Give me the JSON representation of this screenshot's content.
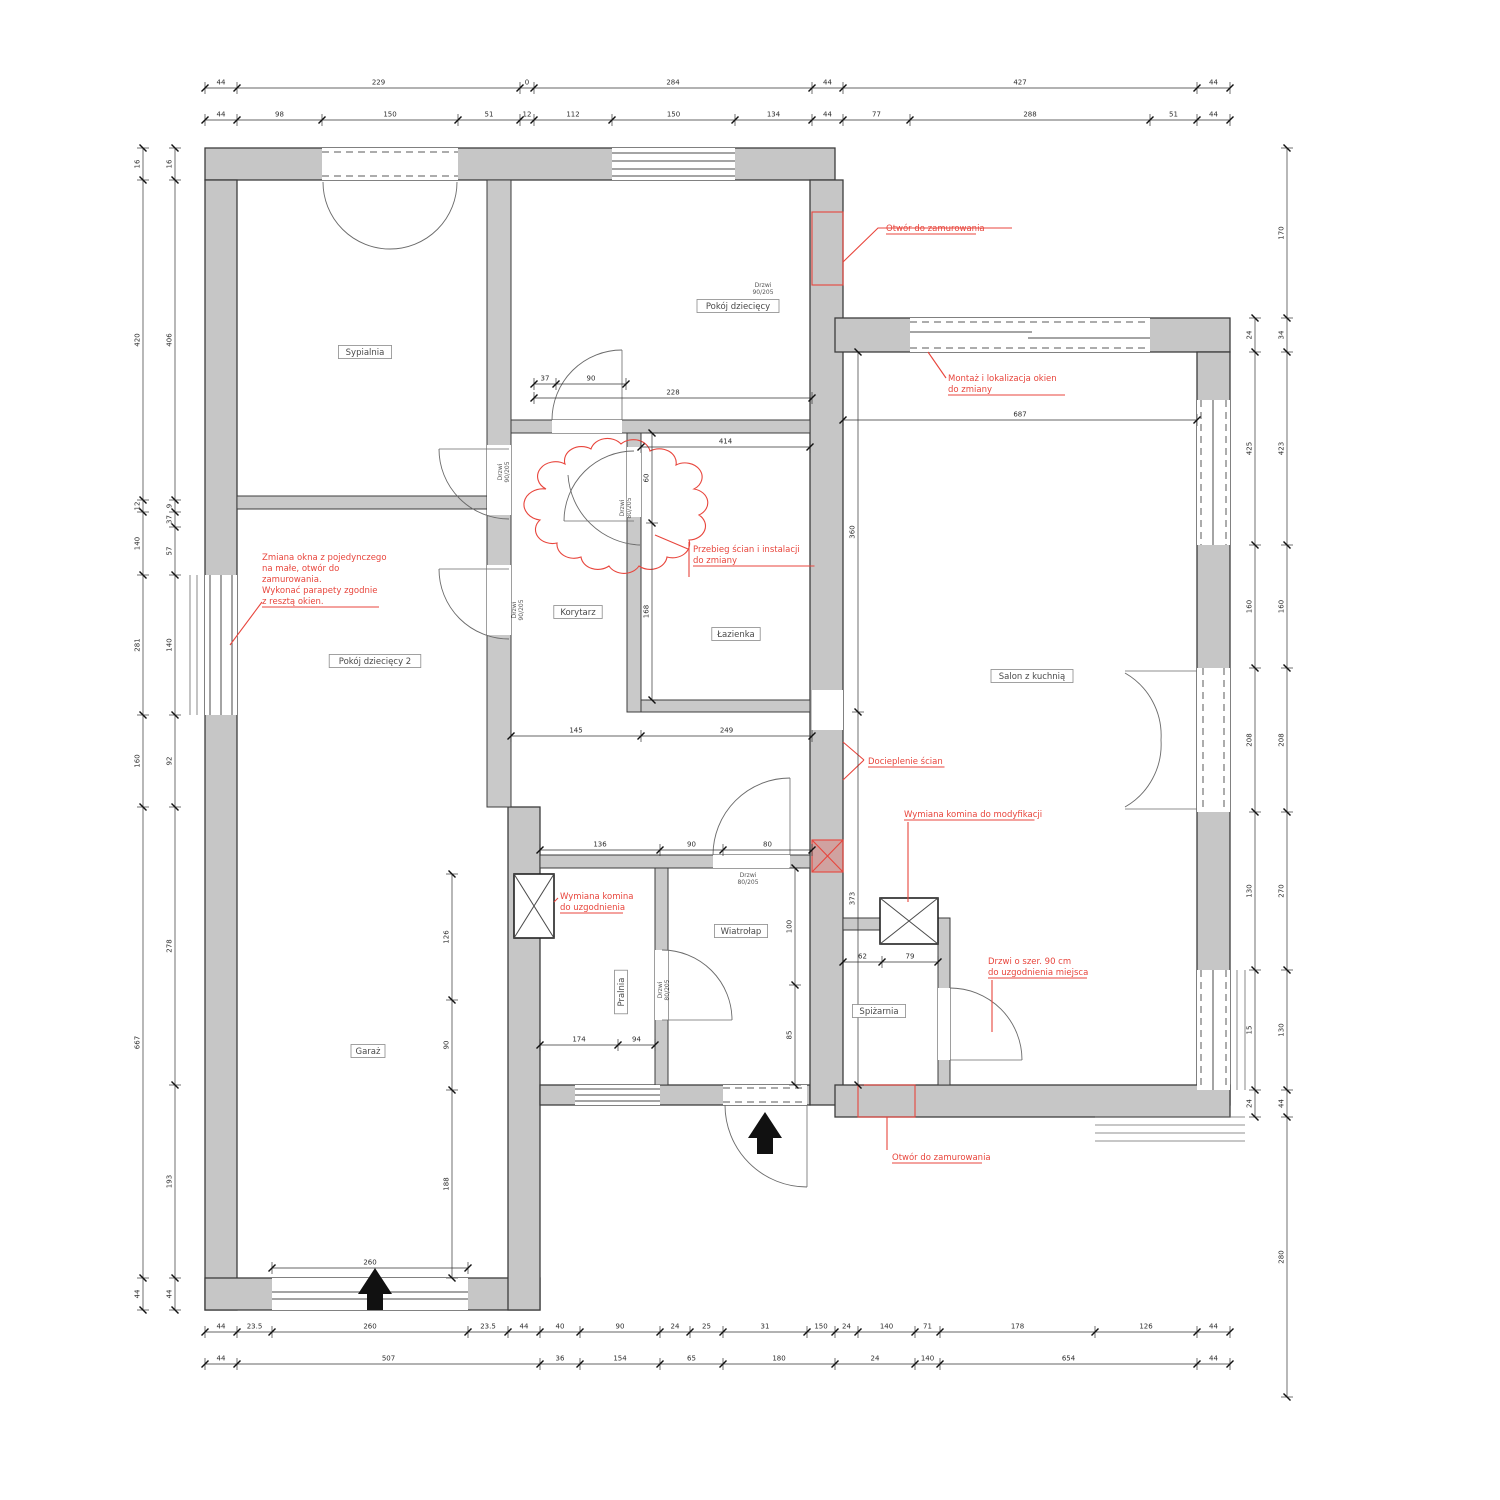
{
  "colors": {
    "wall_fill": "#c6c6c6",
    "wall_stroke": "#3d3d3d",
    "dim": "#2e2e2e",
    "red": "#e8453c",
    "label": "#4a4a4a"
  },
  "rooms": [
    {
      "label": "Sypialnia",
      "x": 365,
      "y": 352,
      "rot": 0
    },
    {
      "label": "Pokój dziecięcy",
      "x": 738,
      "y": 306,
      "rot": 0
    },
    {
      "label": "Pokój dziecięcy 2",
      "x": 375,
      "y": 661,
      "rot": 0
    },
    {
      "label": "Korytarz",
      "x": 578,
      "y": 612,
      "rot": 0
    },
    {
      "label": "Łazienka",
      "x": 736,
      "y": 634,
      "rot": 0
    },
    {
      "label": "Salon z kuchnią",
      "x": 1032,
      "y": 676,
      "rot": 0
    },
    {
      "label": "Wiatrołap",
      "x": 741,
      "y": 931,
      "rot": 0
    },
    {
      "label": "Pralnia",
      "x": 621,
      "y": 992,
      "rot": -90
    },
    {
      "label": "Spiżarnia",
      "x": 879,
      "y": 1011,
      "rot": 0
    },
    {
      "label": "Garaż",
      "x": 368,
      "y": 1051,
      "rot": 0
    }
  ],
  "door_tags": [
    {
      "lines": [
        "Drzwi",
        "90/205"
      ],
      "x": 763,
      "y": 287,
      "rot": 0
    },
    {
      "lines": [
        "Drzwi",
        "90/205"
      ],
      "x": 502,
      "y": 472,
      "rot": -90
    },
    {
      "lines": [
        "Drzwi",
        "90/205"
      ],
      "x": 516,
      "y": 610,
      "rot": -90
    },
    {
      "lines": [
        "Drzwi",
        "80/205"
      ],
      "x": 624,
      "y": 508,
      "rot": -90
    },
    {
      "lines": [
        "Drzwi",
        "80/205"
      ],
      "x": 748,
      "y": 877,
      "rot": 0
    },
    {
      "lines": [
        "Drzwi",
        "80/205"
      ],
      "x": 662,
      "y": 990,
      "rot": -90
    }
  ],
  "annotations": [
    {
      "x": 886,
      "y": 231,
      "lines": [
        "Otwór do zamurowania"
      ]
    },
    {
      "x": 948,
      "y": 381,
      "lines": [
        "Montaż i lokalizacja okien",
        "do zmiany"
      ]
    },
    {
      "x": 262,
      "y": 560,
      "lines": [
        "Zmiana okna z pojedynczego",
        "na małe, otwór do",
        "zamurowania.",
        "Wykonać parapety zgodnie",
        "z resztą okien."
      ]
    },
    {
      "x": 693,
      "y": 552,
      "lines": [
        "Przebieg ścian i instalacji",
        "do zmiany"
      ]
    },
    {
      "x": 868,
      "y": 764,
      "lines": [
        "Docieplenie ścian"
      ]
    },
    {
      "x": 904,
      "y": 817,
      "lines": [
        "Wymiana komina do modyfikacji"
      ]
    },
    {
      "x": 560,
      "y": 899,
      "lines": [
        "Wymiana komina",
        "do uzgodnienia"
      ]
    },
    {
      "x": 988,
      "y": 964,
      "lines": [
        "Drzwi o szer. 90 cm",
        "do uzgodnienia miejsca"
      ]
    },
    {
      "x": 892,
      "y": 1160,
      "lines": [
        "Otwór do zamurowania"
      ]
    }
  ],
  "dim_strips": [
    {
      "o": "h",
      "pos": 88,
      "ticks": [
        205,
        237,
        520,
        534,
        812,
        843,
        1197,
        1230
      ],
      "labels": [
        "44",
        "229",
        "0",
        "284",
        "44",
        "427",
        "44"
      ]
    },
    {
      "o": "h",
      "pos": 120,
      "ticks": [
        205,
        237,
        322,
        458,
        520,
        534,
        612,
        735,
        812,
        843,
        910,
        1150,
        1197,
        1230
      ],
      "labels": [
        "44",
        "98",
        "150",
        "51",
        "12",
        "112",
        "150",
        "134",
        "44",
        "77",
        "288",
        "51",
        "44"
      ]
    },
    {
      "o": "h",
      "pos": 1332,
      "ticks": [
        205,
        237,
        272,
        468,
        508,
        540,
        580,
        660,
        690,
        723,
        807,
        835,
        858,
        915,
        940,
        1095,
        1197,
        1230
      ],
      "labels": [
        "44",
        "23.5",
        "260",
        "23.5",
        "44",
        "40",
        "90",
        "24",
        "25",
        "31",
        "150",
        "24",
        "140",
        "71",
        "178",
        "126",
        "44"
      ]
    },
    {
      "o": "h",
      "pos": 1364,
      "ticks": [
        205,
        237,
        540,
        580,
        660,
        723,
        835,
        915,
        940,
        1197,
        1230
      ],
      "labels": [
        "44",
        "507",
        "36",
        "154",
        "65",
        "180",
        "24",
        "140",
        "654",
        "44"
      ]
    },
    {
      "o": "v",
      "pos": 143,
      "ticks": [
        148,
        180,
        500,
        512,
        575,
        715,
        807,
        1278,
        1310
      ],
      "labels": [
        "16",
        "420",
        "12",
        "140",
        "281",
        "160",
        "667",
        "44"
      ]
    },
    {
      "o": "v",
      "pos": 175,
      "ticks": [
        148,
        180,
        500,
        512,
        527,
        575,
        715,
        807,
        1085,
        1278,
        1310
      ],
      "labels": [
        "16",
        "406",
        "9",
        "37",
        "57",
        "140",
        "92",
        "278",
        "193",
        "44"
      ]
    },
    {
      "o": "v",
      "pos": 1287,
      "ticks": [
        148,
        318,
        352,
        545,
        668,
        812,
        970,
        1090,
        1117,
        1397
      ],
      "labels": [
        "170",
        "34",
        "423",
        "160",
        "208",
        "270",
        "130",
        "44",
        "280"
      ]
    },
    {
      "o": "v",
      "pos": 1255,
      "ticks": [
        318,
        352,
        545,
        668,
        812,
        970,
        1090,
        1117
      ],
      "labels": [
        "24",
        "425",
        "160",
        "208",
        "130",
        "15",
        "24"
      ]
    },
    {
      "o": "h",
      "pos": 398,
      "ticks": [
        534,
        812
      ],
      "labels": [
        "228"
      ]
    },
    {
      "o": "h",
      "pos": 447,
      "ticks": [
        641,
        810
      ],
      "labels": [
        "414"
      ]
    },
    {
      "o": "h",
      "pos": 420,
      "ticks": [
        843,
        1197
      ],
      "labels": [
        "687"
      ]
    },
    {
      "o": "h",
      "pos": 384,
      "ticks": [
        534,
        556,
        626
      ],
      "labels": [
        "37",
        "90"
      ]
    },
    {
      "o": "h",
      "pos": 736,
      "ticks": [
        511,
        641,
        812
      ],
      "labels": [
        "145",
        "249"
      ]
    },
    {
      "o": "h",
      "pos": 850,
      "ticks": [
        540,
        660,
        723,
        812
      ],
      "labels": [
        "136",
        "90",
        "80"
      ]
    },
    {
      "o": "v",
      "pos": 652,
      "ticks": [
        433,
        523,
        700
      ],
      "labels": [
        "60",
        "168"
      ]
    },
    {
      "o": "v",
      "pos": 452,
      "ticks": [
        874,
        1000,
        1090,
        1278
      ],
      "labels": [
        "126",
        "90",
        "188"
      ]
    },
    {
      "o": "h",
      "pos": 1045,
      "ticks": [
        540,
        618,
        655
      ],
      "labels": [
        "174",
        "94"
      ]
    },
    {
      "o": "v",
      "pos": 795,
      "ticks": [
        868,
        985,
        1085
      ],
      "labels": [
        "100",
        "85"
      ]
    },
    {
      "o": "h",
      "pos": 962,
      "ticks": [
        843,
        882,
        938
      ],
      "labels": [
        "62",
        "79"
      ]
    },
    {
      "o": "h",
      "pos": 1268,
      "ticks": [
        272,
        468
      ],
      "labels": [
        "260"
      ]
    },
    {
      "o": "v",
      "pos": 858,
      "ticks": [
        352,
        712,
        1085
      ],
      "labels": [
        "360",
        "373"
      ]
    }
  ]
}
